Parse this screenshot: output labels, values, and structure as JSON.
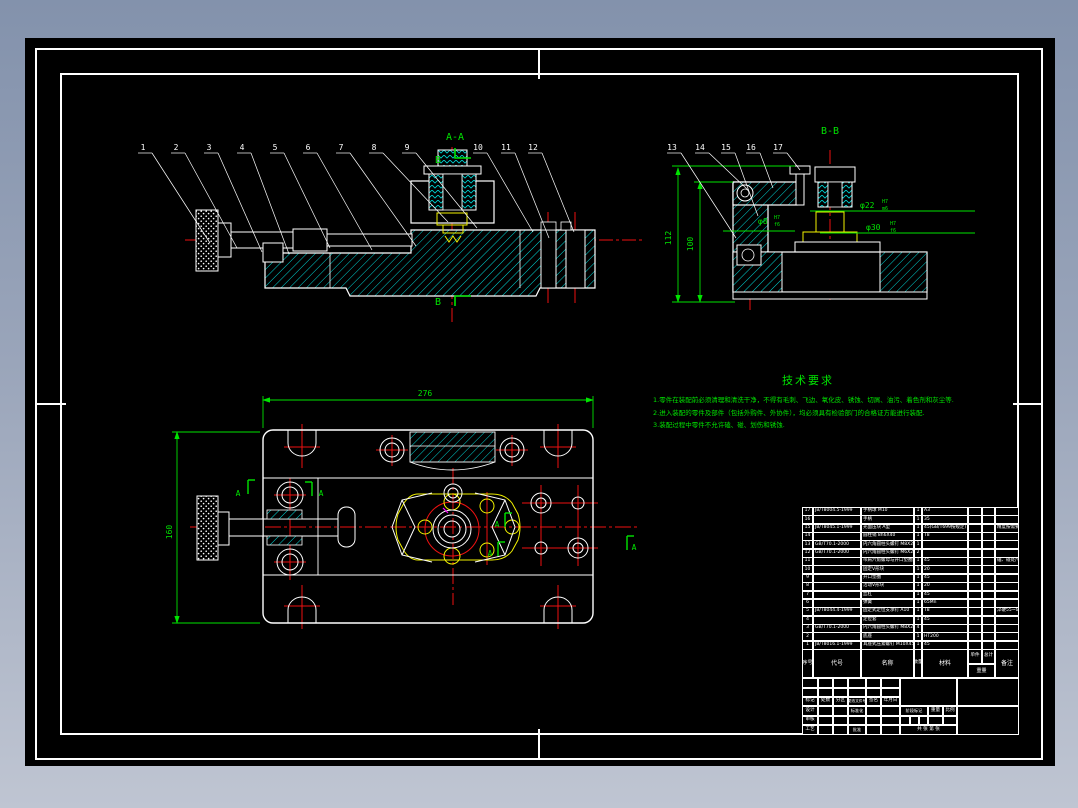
{
  "colors": {
    "background_top": "#8392ac",
    "background_bottom": "#bfc5d2",
    "sheet": "#000000",
    "frame": "#ffffff",
    "outline": "#ffffff",
    "hatch": "#00d7d7",
    "centerline": "#ee1111",
    "detail_yellow": "#f2f200",
    "annotation_green": "#00e400",
    "magenta": "#ff00ff"
  },
  "drawing": {
    "front_view": {
      "section_label": "A-A",
      "cut_label_top": "B",
      "cut_label_bottom": "B",
      "callouts": [
        "1",
        "2",
        "3",
        "4",
        "5",
        "6",
        "7",
        "8",
        "9",
        "10",
        "11",
        "12"
      ]
    },
    "side_view": {
      "section_label": "B-B",
      "callouts": [
        "13",
        "14",
        "15",
        "16",
        "17"
      ],
      "dim_height_outer": "112",
      "dim_height_inner": "100",
      "fits": [
        {
          "dia": "φ8",
          "num": "H7",
          "den": "f6"
        },
        {
          "dia": "φ22",
          "num": "H7",
          "den": "m6"
        },
        {
          "dia": "φ30",
          "num": "H7",
          "den": "f6"
        }
      ]
    },
    "top_view": {
      "dim_width": "276",
      "dim_depth": "160",
      "cut_label": "A"
    }
  },
  "tech_req": {
    "title": "技术要求",
    "lines": [
      "1.零件在装配前必须清理和清洗干净，不得有毛刺、飞边、氧化皮、锈蚀、切屑、油污、着色剂和灰尘等.",
      "2.进入装配的零件及部件（包括外购件、外协件），均必须具有检验部门的合格证方能进行装配.",
      "3.装配过程中零件不允许磕、碰、划伤和锈蚀."
    ]
  },
  "parts_list": {
    "headers": [
      "序号",
      "代号",
      "名称",
      "数量",
      "材料",
      "单件",
      "总计",
      "重量",
      "备注"
    ],
    "rows": [
      [
        "17",
        "JB/T8004.5-1999",
        "手柄球 M10",
        "1",
        "A3",
        "",
        "",
        ""
      ],
      [
        "16",
        "",
        "手柄",
        "1",
        "35",
        "",
        "",
        ""
      ],
      [
        "15",
        "JB/T8045.1-1999",
        "光面压块 A型",
        "1",
        "45(GB/T699按规定)",
        "",
        "",
        "精度按需要选取"
      ],
      [
        "14",
        "",
        "圆柱销 8h6X40",
        "1",
        "T8",
        "",
        "",
        ""
      ],
      [
        "13",
        "GB/T70.1-2000",
        "内六角圆柱头螺钉 M8X20",
        "1",
        "",
        "",
        "",
        ""
      ],
      [
        "12",
        "GB/T70.1-2000",
        "内六角圆柱头螺钉 M6X25",
        "2",
        "",
        "",
        "",
        ""
      ],
      [
        "11",
        "",
        "带肩六角螺母与开口垫圈组合件",
        "1",
        "45",
        "",
        "",
        "磕、碰处尺寸相同"
      ],
      [
        "10",
        "",
        "固定V形块",
        "1",
        "20",
        "",
        "",
        ""
      ],
      [
        "9",
        "",
        "开口垫圈",
        "1",
        "45",
        "",
        "",
        ""
      ],
      [
        "8",
        "",
        "活动V形块",
        "1",
        "20",
        "",
        "",
        ""
      ],
      [
        "7",
        "",
        "丝杠",
        "1",
        "45",
        "",
        "",
        ""
      ],
      [
        "6",
        "",
        "弹簧",
        "1",
        "65Mn",
        "",
        "",
        ""
      ],
      [
        "5",
        "JB/T8044.4-1999",
        "固定式定位支承钉 A10",
        "1",
        "T8",
        "",
        "",
        "淬硬55~60HRC"
      ],
      [
        "4",
        "",
        "定位套",
        "1",
        "45",
        "",
        "",
        ""
      ],
      [
        "3",
        "GB/T70.1-2000",
        "内六角圆柱头螺钉 M8X25",
        "4",
        "",
        "",
        "",
        ""
      ],
      [
        "2",
        "",
        "底座",
        "1",
        "HT200",
        "",
        "",
        ""
      ],
      [
        "1",
        "JB/T8016.1-1999",
        "耳座式压紧螺钉 M10X45",
        "1",
        "45",
        "",
        "",
        ""
      ]
    ]
  },
  "title_block": {
    "change_labels": [
      "标记",
      "处数",
      "分区",
      "更改文件号",
      "签名",
      "年月日"
    ],
    "role_design": "设计",
    "role_standard": "标准化",
    "role_check": "审核",
    "role_process": "工艺",
    "role_approve": "批准",
    "stage_label": "阶段标记",
    "weight_label": "重量",
    "scale_label": "比例",
    "sheet_label": "共  张 第  张"
  }
}
